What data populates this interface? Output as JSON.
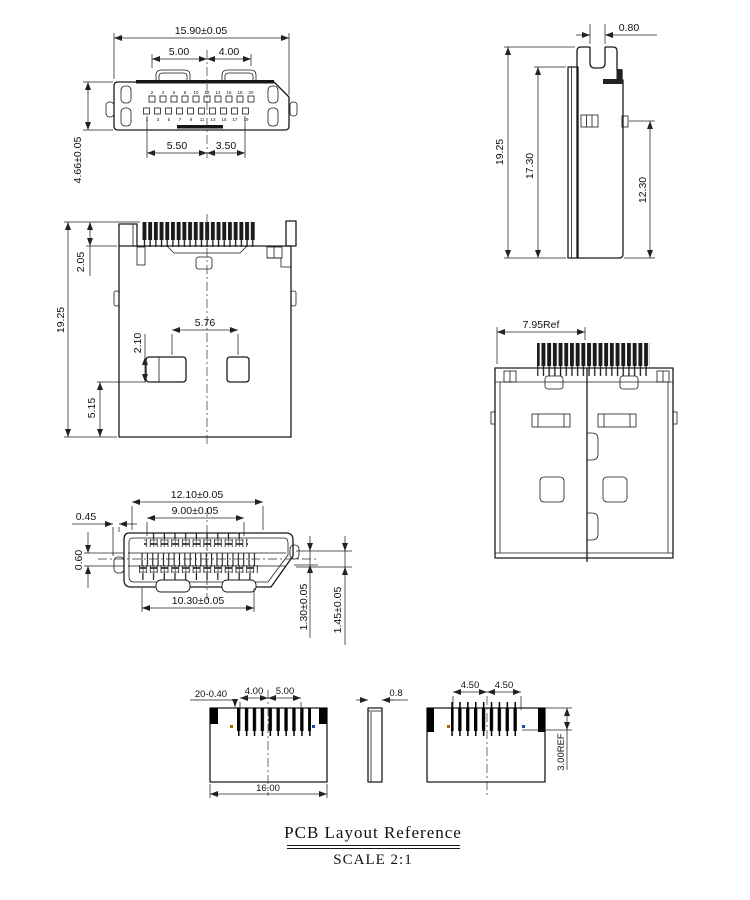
{
  "colors": {
    "line": "#1a1a1a",
    "dim_line": "#222222",
    "dark_fill": "#151515",
    "marker_orange": "#b85c00",
    "marker_blue": "#2244bb"
  },
  "footer": {
    "title": "PCB Layout Reference",
    "scale": "SCALE 2:1"
  },
  "top_view": {
    "dim_overall_width": "15.90±0.05",
    "dim_top_left": "5.00",
    "dim_top_right": "4.00",
    "dim_bottom_left": "5.50",
    "dim_bottom_right": "3.50",
    "dim_height": "4.66±0.05",
    "pins_top": [
      "2",
      "4",
      "6",
      "8",
      "10",
      "12",
      "14",
      "16",
      "18",
      "20"
    ],
    "pins_bottom": [
      "1",
      "3",
      "5",
      "7",
      "9",
      "11",
      "13",
      "15",
      "17",
      "19"
    ]
  },
  "side_view": {
    "dim_slot": "0.80",
    "dim_overall": "19.25",
    "dim_body": "17.30",
    "dim_peg": "12.30"
  },
  "front_view": {
    "dim_tail": "2.05",
    "dim_overall": "19.25",
    "dim_pad_pitch": "5.76",
    "dim_pad_height": "2.10",
    "dim_pad_bottom": "5.15"
  },
  "bottom_view": {
    "dim_ref": "7.95Ref"
  },
  "face_view": {
    "dim_shell": "12.10±0.05",
    "dim_pins_top": "9.00±0.05",
    "dim_lip": "0.45",
    "dim_tongue": "0.60",
    "dim_pins_bottom": "10.30±0.05",
    "dim_step1": "1.30±0.05",
    "dim_step2": "1.45±0.05"
  },
  "pcb_left": {
    "dim_pads": "20-0.40",
    "dim_left": "4.00",
    "dim_right": "5.00",
    "dim_width": "16.00"
  },
  "pcb_mid": {
    "dim_thickness": "0.8"
  },
  "pcb_right": {
    "dim_left": "4.50",
    "dim_right": "4.50",
    "dim_depth": "3.00REF"
  }
}
